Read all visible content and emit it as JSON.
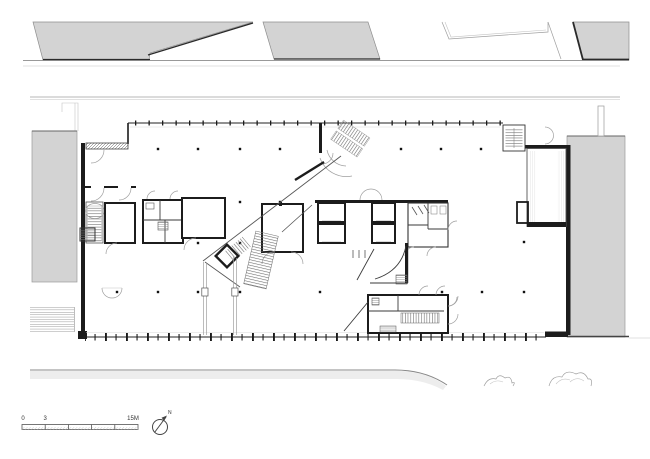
{
  "plan": {
    "scale_bar": {
      "label_start": "0",
      "label_mid": "3",
      "label_end": "15M",
      "segment_count": 5
    },
    "north_arrow": {
      "label": "N"
    }
  },
  "colors": {
    "wall": "#1c1c1c",
    "context_building_fill": "#d3d3d3",
    "road_band_fill": "#ededed",
    "light_line": "#9f9f9f"
  }
}
